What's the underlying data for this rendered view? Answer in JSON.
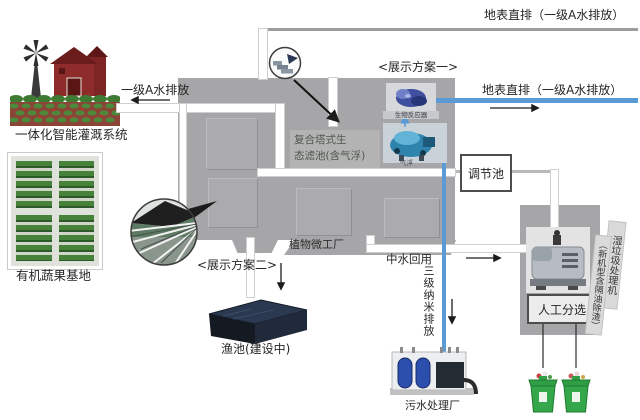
{
  "labels": {
    "surface_discharge_top": "地表直排（一级A水排放）",
    "surface_discharge_mid": "地表直排（一级A水排放）",
    "grade_a_discharge": "一级A水排放",
    "irrigation_system": "一体化智能灌溉系统",
    "organic_vegetable_base": "有机蔬果基地",
    "plan_one": "<展示方案一>",
    "plan_two": "<展示方案二>",
    "eco_filter_pool": "复合塔式生\n态滤池(含气浮)",
    "bioreactor": "生物反应器",
    "air_flotation": "气浮",
    "regulating_pool": "调节池",
    "plant_micro_factory": "植物微工厂",
    "reclaimed_water_reuse": "中水回用",
    "tertiary_nano_discharge": "三级纳米排放",
    "fish_pond": "渔池(建设中)",
    "sewage_plant": "污水处理厂",
    "manual_sorting": "人工分选",
    "wet_waste_machine": "湿垃圾处理机",
    "wet_waste_machine_note": "（新机型含隔油除渣）"
  },
  "illustrations": {
    "farm": "farm-windmill-barn-fields",
    "vegetable_base": "green-planting-beds",
    "greenhouse_photo": "plant-factory-interior-circle",
    "detail_badge": "stairs-structure-magnifier",
    "bioreactor_photo": "blue-bioreactor-machine",
    "air_flotation_photo": "blue-air-flotation-machine",
    "waste_machine_photo": "gray-waste-treatment-machine",
    "sewage_plant_photo": "sewage-treatment-unit",
    "fish_pond_photo": "dark-pond-under-construction",
    "green_bins": "two-green-waste-bins"
  },
  "colors": {
    "building_gray": "#a6a6a8",
    "pipe_white": "#ffffff",
    "pipe_blue": "#5b9bd5",
    "bin_green": "#2f9e44",
    "barn_red": "#8e2b2b",
    "pond_dark": "#161b22"
  }
}
